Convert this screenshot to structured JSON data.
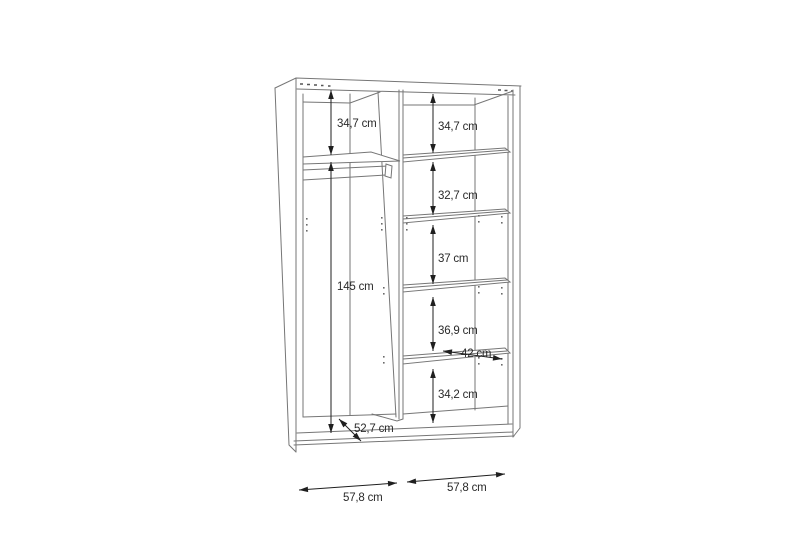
{
  "diagram": {
    "kind": "wardrobe-interior-dimension-drawing",
    "unit": "cm",
    "left_compartment": {
      "top_shelf_gap": "34,7 cm",
      "hanging_height": "145 cm",
      "depth": "52,7 cm",
      "width": "57,8 cm"
    },
    "right_compartment": {
      "section_1": "34,7 cm",
      "section_2": "32,7 cm",
      "section_3": "37 cm",
      "section_4": "36,9 cm",
      "section_5": "34,2 cm",
      "shelf_depth": "42 cm",
      "width": "57,8 cm"
    }
  }
}
